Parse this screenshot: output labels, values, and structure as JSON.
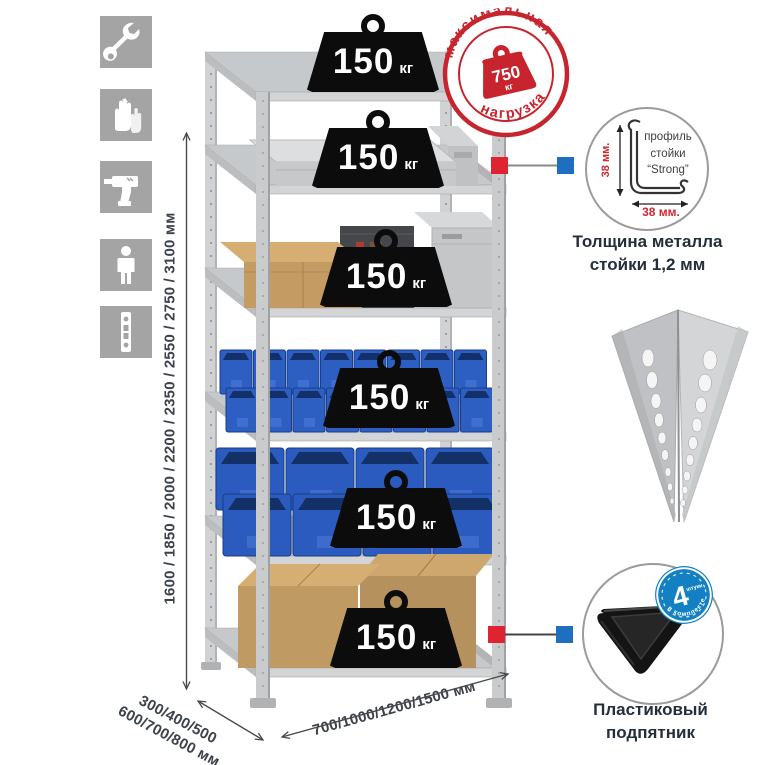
{
  "sidebar": {
    "icons": [
      "wrench-icon",
      "gloves-icon",
      "drill-icon",
      "person-icon",
      "perforated-post-icon"
    ]
  },
  "dimensions": {
    "height_label": "1600 / 1850 / 2000 / 2200 / 2350 / 2550 / 2750 / 3100 мм",
    "depth_label_line1": "300/400/500",
    "depth_label_line2": "600/700/800 мм",
    "width_label": "700/1000/1200/1500 мм"
  },
  "rack": {
    "shelf_count": 6,
    "shelf_loads": [
      {
        "value": "150",
        "unit": "кг"
      },
      {
        "value": "150",
        "unit": "кг"
      },
      {
        "value": "150",
        "unit": "кг"
      },
      {
        "value": "150",
        "unit": "кг"
      },
      {
        "value": "150",
        "unit": "кг"
      },
      {
        "value": "150",
        "unit": "кг"
      }
    ]
  },
  "stamp": {
    "arc_top": "максимальная",
    "arc_bottom": "нагрузка",
    "weight_value": "750",
    "weight_unit": "кг"
  },
  "profile_detail": {
    "line1": "профиль",
    "line2": "стойки",
    "line3": "“Strong”",
    "vertical_dim": "38 мм.",
    "horizontal_dim": "38 мм.",
    "caption_line1": "Толщина металла",
    "caption_line2": "стойки 1,2 мм"
  },
  "foot_detail": {
    "badge_value": "4",
    "badge_small": "штуки",
    "badge_arc": "в комплекте",
    "caption_line1": "Пластиковый",
    "caption_line2": "подпятник"
  },
  "colors": {
    "accent_red": "#cf2a31",
    "callout_red": "#e02330",
    "callout_blue": "#1e6fc0",
    "badge_blue": "#1380c3",
    "metal_gray": "#c6c8ca",
    "bin_blue": "#2d5fc2",
    "cardboard": "#c39b63",
    "weight_black": "#0c0c0c",
    "caption_navy": "#232f3b",
    "dimension_text": "#3c424a"
  }
}
